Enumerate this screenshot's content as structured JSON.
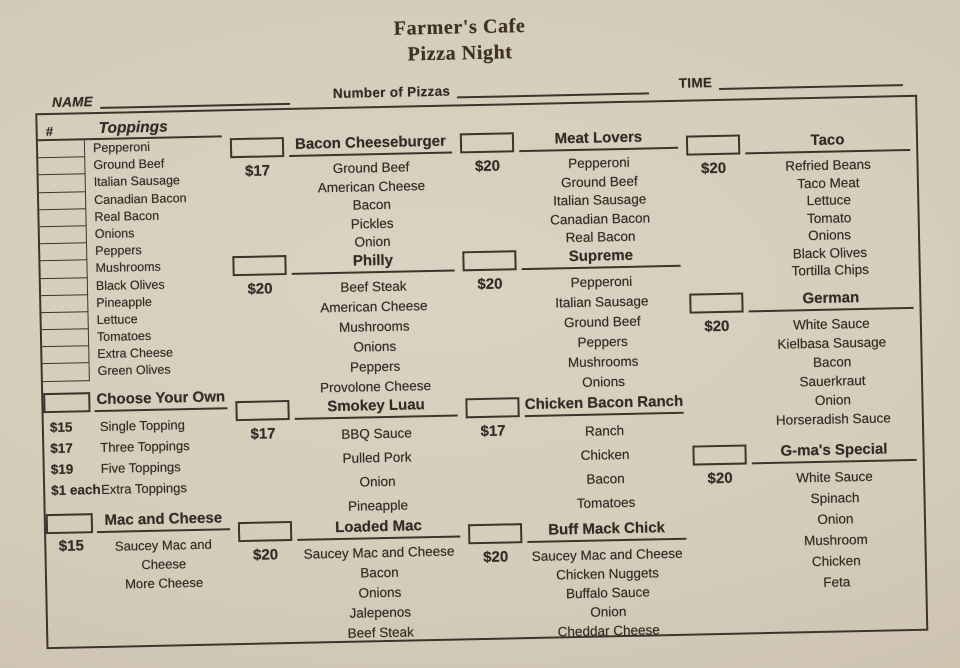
{
  "header": {
    "title_line1": "Farmer's Cafe",
    "title_line2": "Pizza Night",
    "name_label": "NAME",
    "pizzas_label": "Number of Pizzas",
    "time_label": "TIME"
  },
  "toppings": {
    "number_col": "#",
    "title": "Toppings",
    "items": [
      "Pepperoni",
      "Ground Beef",
      "Italian Sausage",
      "Canadian Bacon",
      "Real Bacon",
      "Onions",
      "Peppers",
      "Mushrooms",
      "Black Olives",
      "Pineapple",
      "Lettuce",
      "Tomatoes",
      "Extra Cheese",
      "Green Olives"
    ]
  },
  "choose_your_own": {
    "title": "Choose Your Own",
    "options": [
      {
        "price": "$15",
        "label": "Single Topping"
      },
      {
        "price": "$17",
        "label": "Three Toppings"
      },
      {
        "price": "$19",
        "label": "Five Toppings"
      },
      {
        "price": "$1 each",
        "label": "Extra Toppings"
      }
    ]
  },
  "mac_and_cheese": {
    "title": "Mac and Cheese",
    "price": "$15",
    "ingredients": [
      "Saucey Mac and Cheese",
      "More Cheese"
    ]
  },
  "pizzas": [
    {
      "name": "Bacon Cheeseburger",
      "price": "$17",
      "ingredients": [
        "Ground Beef",
        "American Cheese",
        "Bacon",
        "Pickles",
        "Onion"
      ]
    },
    {
      "name": "Philly",
      "price": "$20",
      "ingredients": [
        "Beef Steak",
        "American Cheese",
        "Mushrooms",
        "Onions",
        "Peppers",
        "Provolone Cheese"
      ]
    },
    {
      "name": "Smokey Luau",
      "price": "$17",
      "ingredients": [
        "BBQ Sauce",
        "Pulled Pork",
        "Onion",
        "Pineapple"
      ]
    },
    {
      "name": "Loaded Mac",
      "price": "$20",
      "ingredients": [
        "Saucey Mac and Cheese",
        "Bacon",
        "Onions",
        "Jalepenos",
        "Beef Steak"
      ]
    },
    {
      "name": "Meat Lovers",
      "price": "$20",
      "ingredients": [
        "Pepperoni",
        "Ground Beef",
        "Italian Sausage",
        "Canadian Bacon",
        "Real Bacon"
      ]
    },
    {
      "name": "Supreme",
      "price": "$20",
      "ingredients": [
        "Pepperoni",
        "Italian Sausage",
        "Ground Beef",
        "Peppers",
        "Mushrooms",
        "Onions"
      ]
    },
    {
      "name": "Chicken Bacon Ranch",
      "price": "$17",
      "ingredients": [
        "Ranch",
        "Chicken",
        "Bacon",
        "Tomatoes"
      ]
    },
    {
      "name": "Buff Mack Chick",
      "price": "$20",
      "ingredients": [
        "Saucey Mac and Cheese",
        "Chicken Nuggets",
        "Buffalo Sauce",
        "Onion",
        "Cheddar Cheese"
      ]
    },
    {
      "name": "Taco",
      "price": "$20",
      "ingredients": [
        "Refried Beans",
        "Taco Meat",
        "Lettuce",
        "Tomato",
        "Onions",
        "Black Olives",
        "Tortilla Chips"
      ]
    },
    {
      "name": "German",
      "price": "$20",
      "ingredients": [
        "White Sauce",
        "Kielbasa Sausage",
        "Bacon",
        "Sauerkraut",
        "Onion",
        "Horseradish Sauce"
      ]
    },
    {
      "name": "G-ma's Special",
      "price": "$20",
      "ingredients": [
        "White Sauce",
        "Spinach",
        "Onion",
        "Mushroom",
        "Chicken",
        "Feta"
      ]
    }
  ],
  "colors": {
    "paper": "#d5ccba",
    "ink": "#312d26",
    "line": "#3a362d"
  }
}
